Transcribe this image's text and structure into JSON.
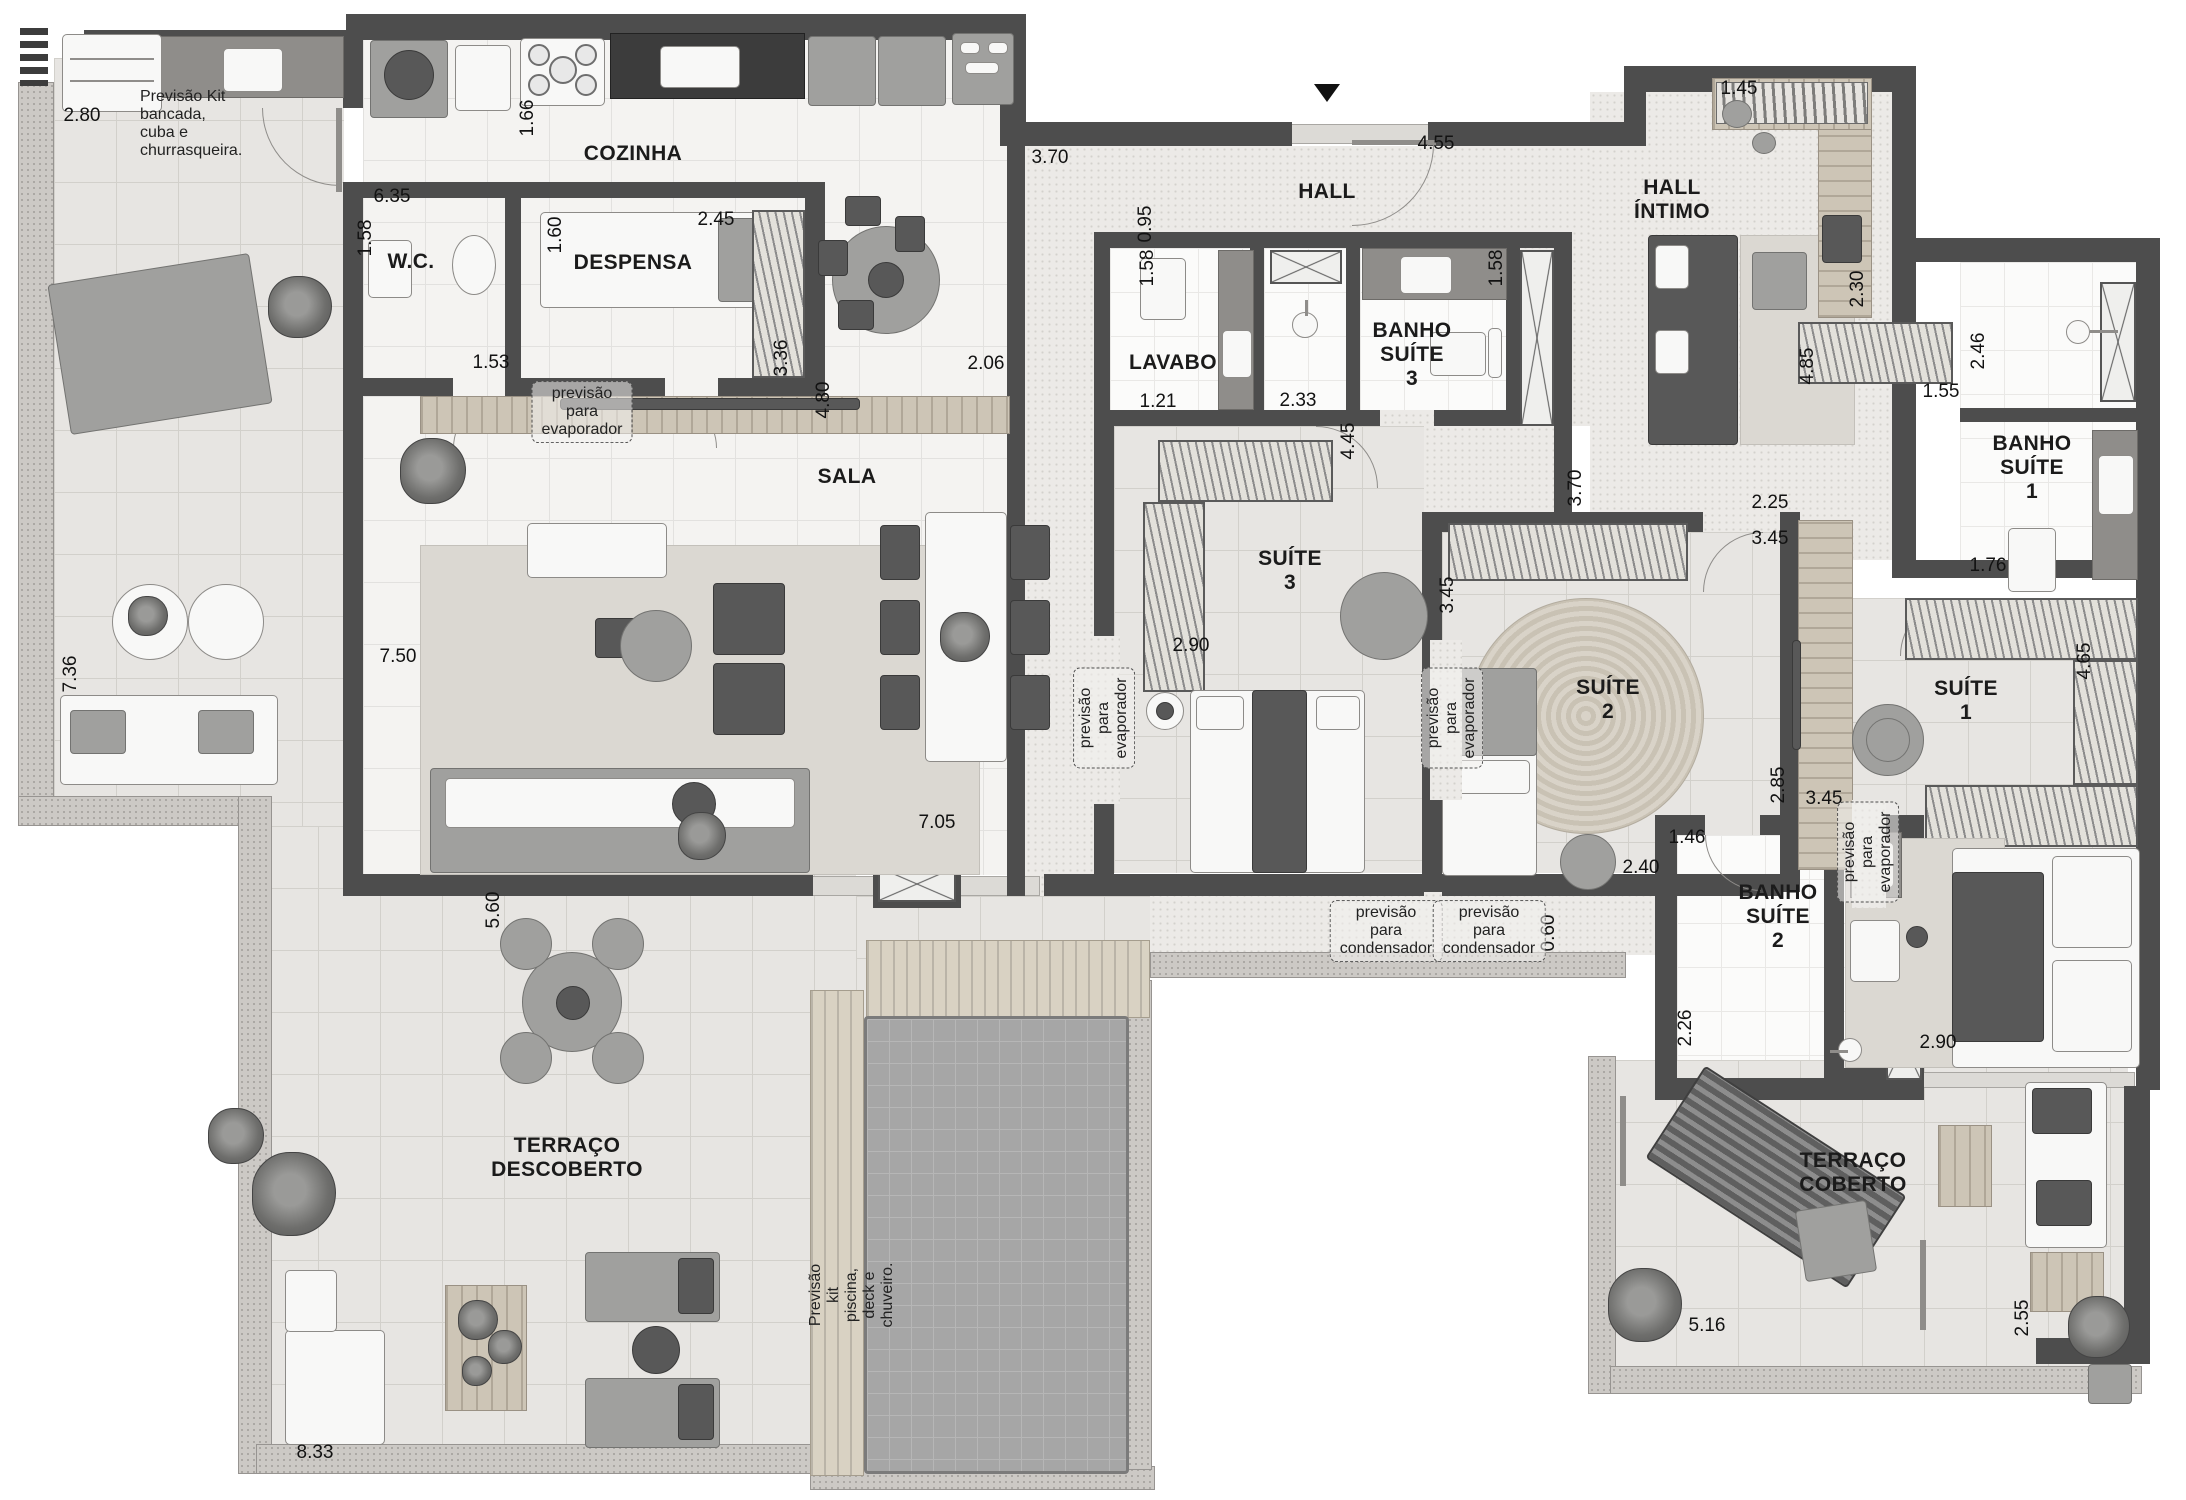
{
  "plan_title": "Apartment floor plan",
  "rooms": [
    {
      "id": "cozinha",
      "label": "COZINHA",
      "x": 633,
      "y": 154
    },
    {
      "id": "wc",
      "label": "W.C.",
      "x": 411,
      "y": 262
    },
    {
      "id": "despensa",
      "label": "DESPENSA",
      "x": 633,
      "y": 263
    },
    {
      "id": "hall",
      "label": "HALL",
      "x": 1327,
      "y": 192
    },
    {
      "id": "hall-intimo",
      "label": "HALL\nÍNTIMO",
      "x": 1672,
      "y": 200
    },
    {
      "id": "lavabo",
      "label": "LAVABO",
      "x": 1173,
      "y": 363
    },
    {
      "id": "banho-suite-3",
      "label": "BANHO\nSUÍTE 3",
      "x": 1412,
      "y": 355
    },
    {
      "id": "banho-suite-1",
      "label": "BANHO\nSUÍTE 1",
      "x": 2032,
      "y": 468
    },
    {
      "id": "sala",
      "label": "SALA",
      "x": 847,
      "y": 477
    },
    {
      "id": "suite-3",
      "label": "SUÍTE 3",
      "x": 1290,
      "y": 571
    },
    {
      "id": "suite-2",
      "label": "SUÍTE 2",
      "x": 1608,
      "y": 700
    },
    {
      "id": "suite-1",
      "label": "SUÍTE 1",
      "x": 1966,
      "y": 701
    },
    {
      "id": "banho-suite-2",
      "label": "BANHO\nSUÍTE 2",
      "x": 1778,
      "y": 917
    },
    {
      "id": "terraco-descoberto",
      "label": "TERRAÇO\nDESCOBERTO",
      "x": 567,
      "y": 1158
    },
    {
      "id": "terraco-coberto",
      "label": "TERRAÇO\nCOBERTO",
      "x": 1853,
      "y": 1173
    }
  ],
  "dimensions": [
    {
      "t": "2.80",
      "x": 82,
      "y": 116,
      "v": false
    },
    {
      "t": "6.35",
      "x": 392,
      "y": 197,
      "v": false
    },
    {
      "t": "1.58",
      "x": 366,
      "y": 238,
      "v": true
    },
    {
      "t": "1.66",
      "x": 528,
      "y": 118,
      "v": true
    },
    {
      "t": "1.60",
      "x": 556,
      "y": 235,
      "v": true
    },
    {
      "t": "2.45",
      "x": 716,
      "y": 220,
      "v": false
    },
    {
      "t": "1.53",
      "x": 491,
      "y": 363,
      "v": false
    },
    {
      "t": "3.36",
      "x": 782,
      "y": 358,
      "v": true
    },
    {
      "t": "2.06",
      "x": 986,
      "y": 364,
      "v": false
    },
    {
      "t": "4.80",
      "x": 824,
      "y": 400,
      "v": true
    },
    {
      "t": "7.50",
      "x": 398,
      "y": 657,
      "v": false
    },
    {
      "t": "3.70",
      "x": 1050,
      "y": 158,
      "v": false
    },
    {
      "t": "4.55",
      "x": 1436,
      "y": 144,
      "v": false
    },
    {
      "t": "0.95",
      "x": 1146,
      "y": 224,
      "v": true
    },
    {
      "t": "1.58",
      "x": 1148,
      "y": 268,
      "v": true
    },
    {
      "t": "1.21",
      "x": 1158,
      "y": 402,
      "v": false
    },
    {
      "t": "2.33",
      "x": 1298,
      "y": 401,
      "v": false
    },
    {
      "t": "1.58",
      "x": 1497,
      "y": 268,
      "v": true
    },
    {
      "t": "1.45",
      "x": 1739,
      "y": 89,
      "v": false
    },
    {
      "t": "2.30",
      "x": 1858,
      "y": 289,
      "v": true
    },
    {
      "t": "2.46",
      "x": 1979,
      "y": 351,
      "v": true
    },
    {
      "t": "1.55",
      "x": 1941,
      "y": 392,
      "v": false
    },
    {
      "t": "1.76",
      "x": 1988,
      "y": 566,
      "v": false
    },
    {
      "t": "4.85",
      "x": 1808,
      "y": 366,
      "v": true
    },
    {
      "t": "4.45",
      "x": 1349,
      "y": 441,
      "v": true
    },
    {
      "t": "2.90",
      "x": 1191,
      "y": 646,
      "v": false
    },
    {
      "t": "3.45",
      "x": 1448,
      "y": 595,
      "v": true
    },
    {
      "t": "3.70",
      "x": 1576,
      "y": 488,
      "v": true
    },
    {
      "t": "2.25",
      "x": 1770,
      "y": 503,
      "v": false
    },
    {
      "t": "3.45",
      "x": 1770,
      "y": 539,
      "v": false
    },
    {
      "t": "2.85",
      "x": 1779,
      "y": 785,
      "v": true
    },
    {
      "t": "3.45",
      "x": 1824,
      "y": 799,
      "v": false
    },
    {
      "t": "4.65",
      "x": 2085,
      "y": 661,
      "v": true
    },
    {
      "t": "7.36",
      "x": 71,
      "y": 674,
      "v": true
    },
    {
      "t": "7.05",
      "x": 937,
      "y": 823,
      "v": false
    },
    {
      "t": "5.60",
      "x": 494,
      "y": 910,
      "v": true
    },
    {
      "t": "1.46",
      "x": 1687,
      "y": 838,
      "v": false
    },
    {
      "t": "2.40",
      "x": 1641,
      "y": 868,
      "v": false
    },
    {
      "t": "0.60",
      "x": 1549,
      "y": 933,
      "v": true
    },
    {
      "t": "2.26",
      "x": 1686,
      "y": 1028,
      "v": true
    },
    {
      "t": "2.90",
      "x": 1938,
      "y": 1043,
      "v": false
    },
    {
      "t": "5.16",
      "x": 1707,
      "y": 1326,
      "v": false
    },
    {
      "t": "2.55",
      "x": 2023,
      "y": 1318,
      "v": true
    },
    {
      "t": "8.33",
      "x": 315,
      "y": 1453,
      "v": false
    }
  ],
  "annotations": [
    {
      "id": "kit-bancada",
      "t": "Previsão Kit bancada,\ncuba e churrasqueira.",
      "x": 140,
      "y": 124,
      "v": false,
      "boxed": false,
      "left": true
    },
    {
      "id": "evaporador-1",
      "t": "previsão para\nevaporador",
      "x": 582,
      "y": 412,
      "v": false,
      "boxed": true,
      "left": false
    },
    {
      "id": "evaporador-2",
      "t": "previsão para\nevaporador",
      "x": 1104,
      "y": 718,
      "v": true,
      "boxed": true,
      "left": false
    },
    {
      "id": "evaporador-3",
      "t": "previsão para\nevaporador",
      "x": 1452,
      "y": 718,
      "v": true,
      "boxed": true,
      "left": false
    },
    {
      "id": "evaporador-4",
      "t": "previsão para\nevaporador",
      "x": 1868,
      "y": 852,
      "v": true,
      "boxed": true,
      "left": false
    },
    {
      "id": "condensador-1",
      "t": "previsão para\ncondensador",
      "x": 1386,
      "y": 931,
      "v": false,
      "boxed": true,
      "left": false
    },
    {
      "id": "condensador-2",
      "t": "previsão para\ncondensador",
      "x": 1489,
      "y": 931,
      "v": false,
      "boxed": true,
      "left": false
    },
    {
      "id": "kit-piscina",
      "t": "Previsão kit piscina, deck e chuveiro.",
      "x": 852,
      "y": 1295,
      "v": true,
      "boxed": false,
      "left": false
    }
  ],
  "entrance": {
    "symbol": "down-arrow",
    "x": 1327,
    "y": 84
  }
}
